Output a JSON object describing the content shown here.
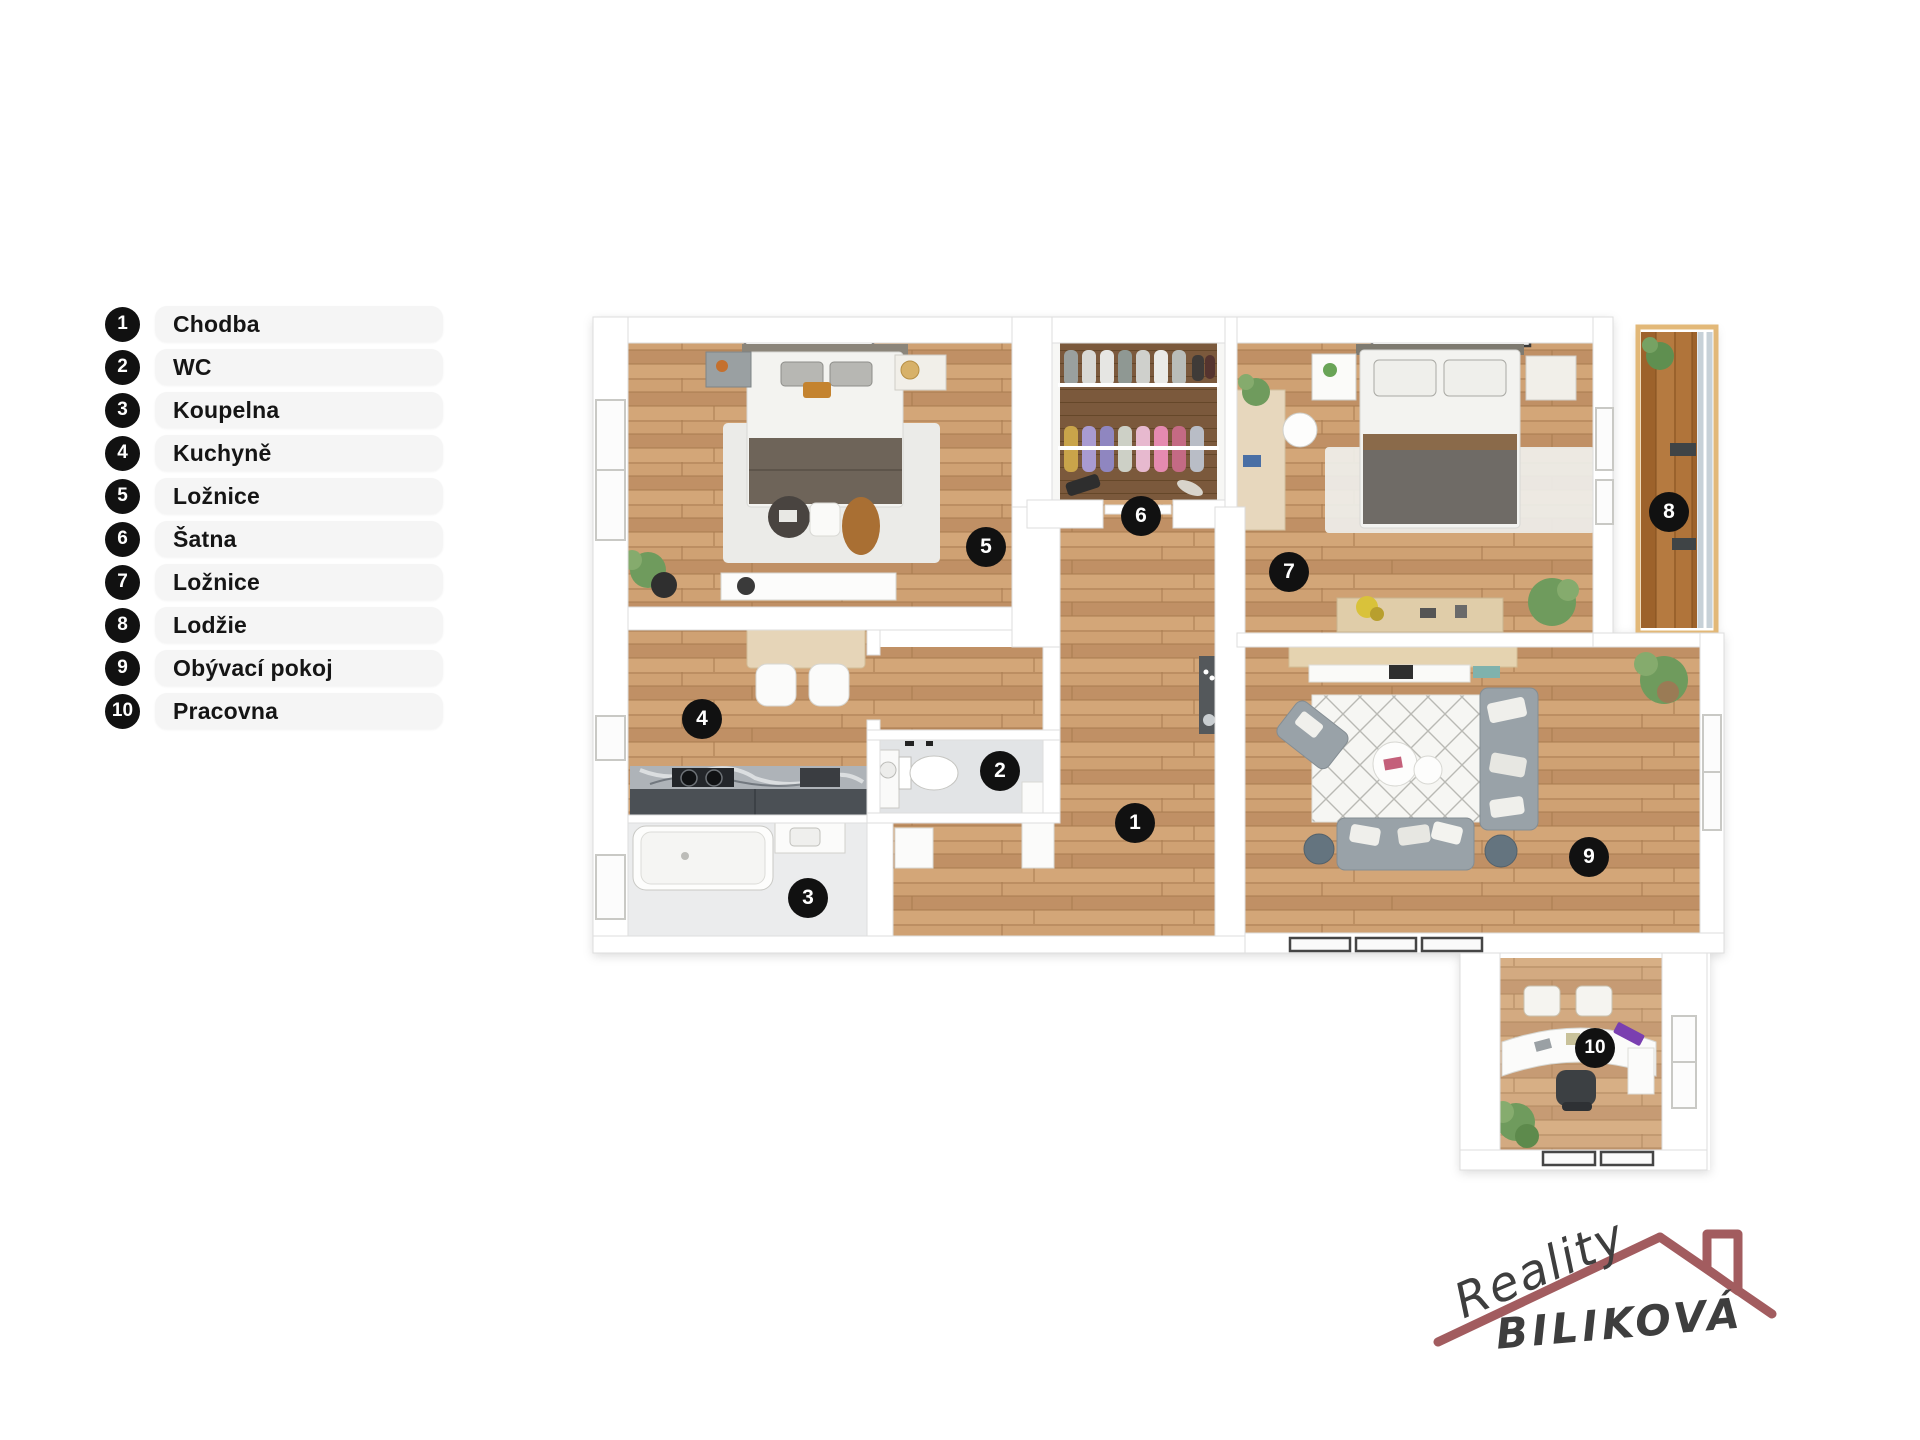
{
  "legend": {
    "items": [
      {
        "number": "1",
        "label": "Chodba"
      },
      {
        "number": "2",
        "label": "WC"
      },
      {
        "number": "3",
        "label": "Koupelna"
      },
      {
        "number": "4",
        "label": "Kuchyně"
      },
      {
        "number": "5",
        "label": "Ložnice"
      },
      {
        "number": "6",
        "label": "Šatna"
      },
      {
        "number": "7",
        "label": "Ložnice"
      },
      {
        "number": "8",
        "label": "Lodžie"
      },
      {
        "number": "9",
        "label": "Obývací pokoj"
      },
      {
        "number": "10",
        "label": "Pracovna"
      }
    ]
  },
  "plan": {
    "markers": [
      {
        "number": "1",
        "x": 1135,
        "y": 823
      },
      {
        "number": "2",
        "x": 1000,
        "y": 771
      },
      {
        "number": "3",
        "x": 808,
        "y": 898
      },
      {
        "number": "4",
        "x": 702,
        "y": 719
      },
      {
        "number": "5",
        "x": 986,
        "y": 547
      },
      {
        "number": "6",
        "x": 1141,
        "y": 516
      },
      {
        "number": "7",
        "x": 1289,
        "y": 572
      },
      {
        "number": "8",
        "x": 1669,
        "y": 512
      },
      {
        "number": "9",
        "x": 1589,
        "y": 857
      },
      {
        "number": "10",
        "x": 1595,
        "y": 1048
      }
    ]
  },
  "logo": {
    "brand_script": "Reality",
    "brand_name": "BILIKOVÁ"
  },
  "colors": {
    "marker": "#111111",
    "marker_text": "#ffffff",
    "pill": "#f5f5f5",
    "label": "#151515",
    "roof": "#a25c5f",
    "logo_text": "#3e3e3e"
  }
}
